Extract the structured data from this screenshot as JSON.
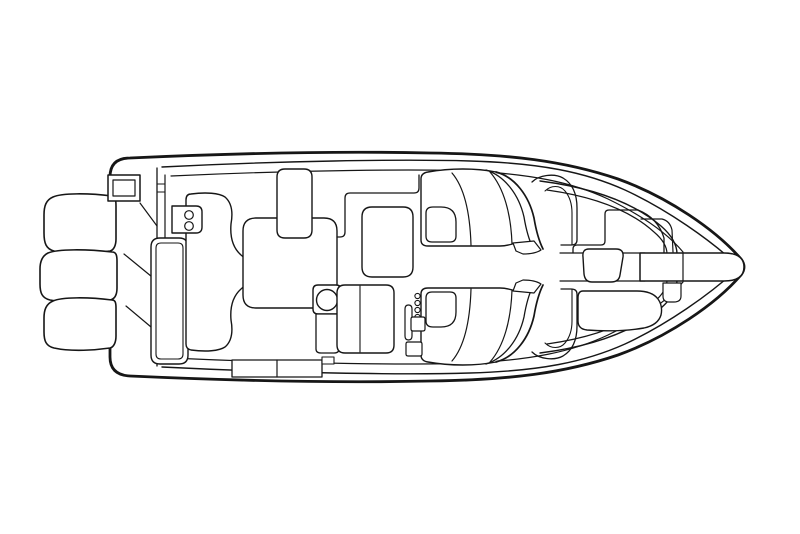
{
  "canvas": {
    "width": 800,
    "height": 534,
    "mirror_axis_y": 267
  },
  "colors": {
    "line": "#161616",
    "background": "#ffffff"
  },
  "diagram": {
    "subject": "boat-deck-plan-top-view",
    "style": "line-art"
  },
  "shapes": [
    {
      "name": "hull-outline",
      "sw": 2.8,
      "fill": "white",
      "d": "M 110,177 Q 110,158 130,158 C 240,153 340,151 430,153 C 510,154 565,161 618,179 C 668,197 716,230 741,259 Q 747,267 741,275 C 716,304 668,337 618,355 C 565,373 510,380 430,381 C 340,383 240,381 130,376 Q 110,375 110,357 Z"
    },
    {
      "name": "sheer-line-top",
      "sw": 1.4,
      "d": "M 162,167 C 280,161 400,159 470,161 C 540,163 585,172 625,190 C 668,210 710,240 735,263"
    },
    {
      "name": "sheer-line-bottom",
      "sw": 1.4,
      "d": "M 162,367 C 280,373 400,375 470,373 C 540,371 585,362 625,344 C 668,324 710,294 735,271"
    },
    {
      "name": "gunwale-line-top",
      "sw": 1.2,
      "d": "M 171,176 C 300,170 420,169 470,171 C 530,174 572,182 608,199 C 645,217 668,234 683,252"
    },
    {
      "name": "gunwale-line-bottom",
      "sw": 1.2,
      "d": "M 171,358 C 300,364 420,365 470,363 C 530,360 572,352 608,335 C 645,317 668,300 683,282"
    },
    {
      "name": "transom-wall-line-outer",
      "sw": 1.3,
      "d": "M 157,168 L 157,366"
    },
    {
      "name": "transom-wall-line-inner",
      "sw": 1.2,
      "d": "M 165,175 L 165,359"
    },
    {
      "name": "transom-wall-tick-1",
      "sw": 1.0,
      "d": "M 157,184 L 165,184"
    },
    {
      "name": "transom-wall-tick-2",
      "sw": 1.0,
      "d": "M 157,192 L 165,192"
    },
    {
      "name": "outboard-motor-1",
      "sw": 1.6,
      "fill": "white",
      "d": "M 112,196 C 88,193 62,193 53,197 C 46,200 44,206 44,215 L 44,233 C 44,243 46,249 54,251 C 72,255 96,253 110,251 C 114,250 116,245 116,239 L 116,206 C 116,199 115,196 112,196 Z"
    },
    {
      "name": "outboard-motor-2",
      "sw": 1.6,
      "fill": "white",
      "d": "M 112,252 C 86,249 58,249 48,253 C 42,256 40,262 40,269 L 40,284 C 40,293 42,298 50,300 C 70,304 96,302 110,300 C 115,299 117,294 117,288 L 117,261 C 117,255 116,252 112,252 Z"
    },
    {
      "name": "outboard-motor-3",
      "sw": 1.6,
      "fill": "white",
      "d": "M 112,300 C 88,297 62,297 53,301 C 46,304 44,310 44,318 L 44,332 C 44,341 46,346 54,348 C 72,352 96,350 110,348 C 114,347 116,342 116,336 L 116,308 C 116,302 115,300 112,300 Z"
    },
    {
      "name": "transom-hatch-outer",
      "sw": 1.5,
      "fill": "white",
      "d": "M 108,175 L 140,175 L 140,201 L 108,201 Z"
    },
    {
      "name": "transom-hatch-inner",
      "sw": 1.2,
      "d": "M 113,180 L 135,180 L 135,196 L 113,196 Z"
    },
    {
      "name": "engine-bracket-diagonal-1",
      "sw": 1.2,
      "d": "M 140,203 L 157,226"
    },
    {
      "name": "engine-bracket-diagonal-2",
      "sw": 1.2,
      "d": "M 124,254 L 157,281"
    },
    {
      "name": "engine-bracket-diagonal-3",
      "sw": 1.2,
      "d": "M 126,306 L 157,332"
    },
    {
      "name": "aft-bench-backrest-outer",
      "sw": 1.4,
      "fill": "white",
      "d": "M 160,238 L 179,238 Q 188,238 188,247 L 188,355 Q 188,364 179,364 L 160,364 Q 151,364 151,355 L 151,247 Q 151,238 160,238 Z"
    },
    {
      "name": "aft-bench-backrest-inner",
      "sw": 1.1,
      "d": "M 161,243 L 178,243 Q 183,243 183,248 L 183,354 Q 183,359 178,359 L 161,359 Q 156,359 156,354 L 156,248 Q 156,243 161,243 Z"
    },
    {
      "name": "aft-bench-cushion",
      "sw": 1.4,
      "fill": "white",
      "d": "M 191,194 C 206,192 219,193 225,197 C 232,203 233,213 231,224 C 230,236 232,247 241,255 Q 250,262 250,272 Q 250,282 241,289 C 232,297 230,308 231,320 C 233,331 232,341 225,347 C 219,351 206,352 191,350 Q 186,349 186,344 L 186,200 Q 186,194 191,194 Z"
    },
    {
      "name": "transom-plate",
      "sw": 1.4,
      "fill": "white",
      "d": "M 172,206 L 196,206 Q 202,206 202,212 L 202,227 Q 202,233 196,233 L 172,233 Z"
    },
    {
      "name": "cup-holder-1",
      "sw": 1.2,
      "c": [
        189,
        215
      ],
      "r": 4.3
    },
    {
      "name": "cup-holder-2",
      "sw": 1.2,
      "c": [
        189,
        226
      ],
      "r": 4.3
    },
    {
      "name": "storage-sunpad",
      "sw": 1.4,
      "fill": "white",
      "d": "M 256,218 L 324,218 Q 337,218 337,231 L 337,295 Q 337,308 324,308 L 256,308 Q 243,308 243,295 L 243,231 Q 243,218 256,218 Z"
    },
    {
      "name": "cockpit-seat-backrest",
      "sw": 1.4,
      "fill": "white",
      "d": "M 285,169 L 304,169 Q 312,169 312,177 L 312,230 Q 312,238 304,238 L 285,238 Q 277,238 277,230 L 277,177 Q 277,169 285,169 Z"
    },
    {
      "name": "side-deck-edge",
      "sw": 1.3,
      "d": "M 419,175 L 419,188 Q 419,193 414,193 L 350,193 Q 345,193 345,198 L 345,232 Q 345,237 340,237 L 337,237"
    },
    {
      "name": "cockpit-table",
      "sw": 1.4,
      "fill": "white",
      "d": "M 372,207 L 403,207 Q 413,207 413,217 L 413,267 Q 413,277 403,277 L 372,277 Q 362,277 362,267 L 362,217 Q 362,207 372,207 Z"
    },
    {
      "name": "bow-liner-outer",
      "sw": 1.4,
      "d": "M 540,181 C 595,188 634,203 661,226 Q 677,240 677,254 L 677,280 Q 677,294 661,308 C 634,331 595,346 540,353"
    },
    {
      "name": "bow-liner-inner",
      "sw": 1.2,
      "d": "M 547,190 C 597,197 631,211 654,232 Q 667,243 667,254 L 667,280 Q 667,291 654,302 C 631,323 597,337 547,344"
    },
    {
      "name": "bow-step-edge",
      "sw": 1.3,
      "d": "M 638,210 L 609,210 Q 605,210 605,214 L 605,241 Q 605,245 601,245 L 577,245 Q 573,245 573,249 L 573,253"
    },
    {
      "name": "bow-step-corner",
      "sw": 1.3,
      "d": "M 638,210 Q 658,218 664,238 L 664,253"
    },
    {
      "name": "bow-walkway-edge-top",
      "sw": 1.2,
      "d": "M 560,253 L 645,253"
    },
    {
      "name": "bow-walkway-edge-bottom",
      "sw": 1.2,
      "d": "M 560,281 L 645,281"
    },
    {
      "name": "bow-step-upper",
      "sw": 1.2,
      "d": "M 641,219 L 662,219 Q 670,221 672,230 L 673,252"
    },
    {
      "name": "anchor-platform-strip",
      "sw": 1.5,
      "fill": "white",
      "d": "M 640,253 L 724,253 Q 744,253 744,267 Q 744,281 724,281 L 640,281 Z"
    },
    {
      "name": "anchor-platform-seam",
      "sw": 1.2,
      "d": "M 683,253 L 683,281"
    },
    {
      "name": "bow-step-lower",
      "sw": 1.2,
      "fill": "white",
      "d": "M 663,283 L 681,283 L 681,296 Q 681,302 674,302 L 669,302 Q 663,302 663,296 Z"
    },
    {
      "name": "bow-cushion",
      "sw": 1.4,
      "fill": "white",
      "d": "M 589,249 L 616,249 Q 624,249 623,257 L 620,275 Q 619,282 611,282 L 592,282 Q 585,282 584,274 L 583,257 Q 582,249 589,249 Z"
    },
    {
      "name": "bow-seat-forward",
      "sw": 1.4,
      "fill": "white",
      "d": "M 583,291 L 637,291 Q 652,291 658,299 Q 663,306 661,315 Q 658,325 644,328 C 620,332 600,331 587,330 Q 578,329 578,321 L 578,298 Q 578,291 583,291 Z"
    },
    {
      "name": "console-body",
      "sw": 1.4,
      "fill": "white",
      "mirror": true,
      "d": "M 496,172 C 476,168 450,168 428,172 Q 421,173 421,179 L 421,240 Q 421,246 428,246 L 500,246 C 507,246 512,244 516,243"
    },
    {
      "name": "windshield-outer",
      "sw": 1.7,
      "mirror": true,
      "d": "M 496,172 C 515,177 529,196 534,218 C 536,230 539,241 543,249"
    },
    {
      "name": "windshield-inner",
      "sw": 1.3,
      "mirror": true,
      "d": "M 486,170 C 505,176 519,195 524,217 C 526,229 529,240 533,248"
    },
    {
      "name": "windshield-foot",
      "sw": 1.2,
      "fill": "white",
      "mirror": true,
      "d": "M 513,243 L 534,241 L 541,250 Q 535,254 523,254 L 516,251 Z"
    },
    {
      "name": "console-curve-1",
      "sw": 1.2,
      "mirror": true,
      "d": "M 452,173 C 464,187 470,212 471,245"
    },
    {
      "name": "console-curve-2",
      "sw": 1.2,
      "mirror": true,
      "d": "M 490,172 C 504,188 511,214 512,244"
    },
    {
      "name": "console-seat",
      "sw": 1.3,
      "fill": "white",
      "mirror": true,
      "d": "M 433,207 L 441,207 Q 456,207 456,222 L 456,236 Q 456,242 450,242 L 432,242 Q 426,242 426,236 L 426,213 Q 426,207 433,207 Z"
    },
    {
      "name": "bow-seatback-curve-outer",
      "sw": 1.3,
      "mirror": true,
      "d": "M 532,182 C 539,175 554,173 563,178 C 573,184 577,195 577,208 L 577,240 Q 577,245 571,245 L 561,245"
    },
    {
      "name": "bow-seatback-curve-inner",
      "sw": 1.1,
      "mirror": true,
      "d": "M 545,191 C 551,185 560,185 565,191 C 570,197 572,205 572,213 L 572,245"
    },
    {
      "name": "wetbar-pedestal",
      "sw": 1.4,
      "fill": "white",
      "d": "M 318,285 L 336,285 Q 341,285 341,290 L 341,309 Q 341,314 336,314 L 318,314 Q 313,314 313,309 L 313,290 Q 313,285 318,285 Z"
    },
    {
      "name": "sink-basin",
      "sw": 1.4,
      "fill": "white",
      "c": [
        327,
        300
      ],
      "r": 10.5
    },
    {
      "name": "wetbar-cabinet",
      "sw": 1.3,
      "fill": "white",
      "d": "M 316,314 L 339,314 L 339,349 Q 339,353 334,353 L 321,353 Q 316,353 316,349 Z"
    },
    {
      "name": "helm-seat",
      "sw": 1.4,
      "fill": "white",
      "d": "M 345,285 L 386,285 Q 394,285 394,293 L 394,345 Q 394,353 386,353 L 345,353 Q 337,353 337,345 L 337,293 Q 337,285 345,285 Z"
    },
    {
      "name": "helm-seat-divider",
      "sw": 1.1,
      "d": "M 360,286 L 360,352"
    },
    {
      "name": "grab-rail",
      "sw": 1.2,
      "fill": "white",
      "d": "M 408.5,305 Q 412,305 412,309 L 412,336 Q 412,340 408.5,340 Q 405,340 405,336 L 405,309 Q 405,305 408.5,305 Z"
    },
    {
      "name": "hinge-dot-1",
      "sw": 1.1,
      "c": [
        417.5,
        296
      ],
      "r": 2.6
    },
    {
      "name": "hinge-dot-2",
      "sw": 1.1,
      "c": [
        417.5,
        303
      ],
      "r": 2.6
    },
    {
      "name": "hinge-dot-3",
      "sw": 1.1,
      "c": [
        417.5,
        310
      ],
      "r": 2.6
    },
    {
      "name": "hinge-dot-4",
      "sw": 1.1,
      "c": [
        417.5,
        317
      ],
      "r": 2.6
    },
    {
      "name": "console-latch",
      "sw": 1.2,
      "fill": "white",
      "d": "M 413,317 L 423,317 Q 425,317 425,319 L 425,329 Q 425,331 423,331 L 413,331 Q 411,331 411,329 L 411,319 Q 411,317 413,317 Z"
    },
    {
      "name": "console-latch-lower",
      "sw": 1.2,
      "fill": "white",
      "d": "M 408,342 L 420,342 Q 422,342 422,344 L 422,354 Q 422,356 420,356 L 408,356 Q 406,356 406,354 L 406,344 Q 406,342 408,342 Z"
    },
    {
      "name": "gunwale-step",
      "sw": 1.3,
      "fill": "white",
      "d": "M 232,360 L 322,360 L 322,377 L 232,377 Z"
    },
    {
      "name": "gunwale-step-divider",
      "sw": 1.2,
      "d": "M 277,360 L 277,377"
    },
    {
      "name": "gunwale-step-small",
      "sw": 1.1,
      "fill": "white",
      "d": "M 322,357 L 334,357 L 334,364 L 322,364 Z"
    }
  ]
}
